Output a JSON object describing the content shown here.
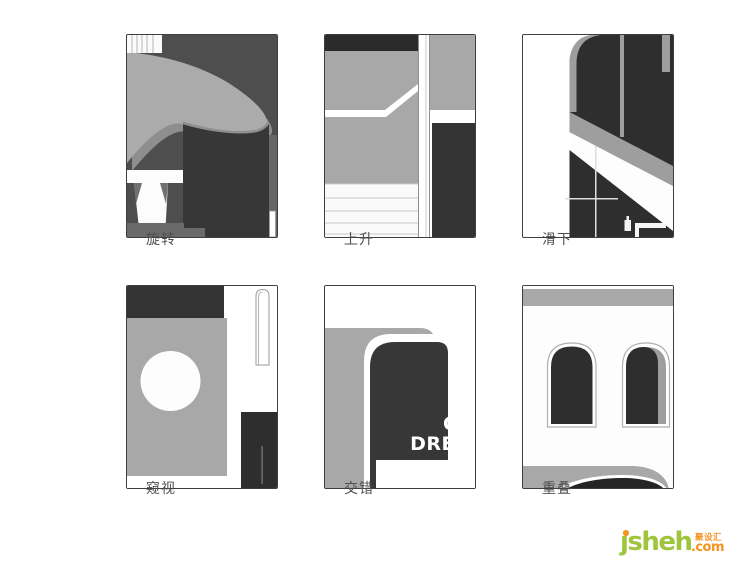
{
  "page": {
    "background": "#ffffff"
  },
  "panels": [
    {
      "id": "rotate",
      "label": "旋转"
    },
    {
      "id": "rise",
      "label": "上升"
    },
    {
      "id": "slide-down",
      "label": "滑下"
    },
    {
      "id": "peek",
      "label": "窥视"
    },
    {
      "id": "interlace",
      "label": "交错",
      "arch_text_line1": "C",
      "arch_text_line2": "DRE"
    },
    {
      "id": "overlap",
      "label": "重叠"
    }
  ],
  "logo": {
    "name": "ȷsheh",
    "cn": "聚设汇",
    "tld": ".com",
    "green": "#9fc43d",
    "orange": "#f6921e"
  },
  "palette": {
    "dark": "#2e2e2e",
    "cylinder_dark": "#373737",
    "panel1_bg": "#4e4e4e",
    "mid_gray": "#6e6e6e",
    "light_gray": "#a8a8a8",
    "white": "#ffffff",
    "border": "#3e3e3e",
    "caption_text": "#4f4f4f"
  }
}
